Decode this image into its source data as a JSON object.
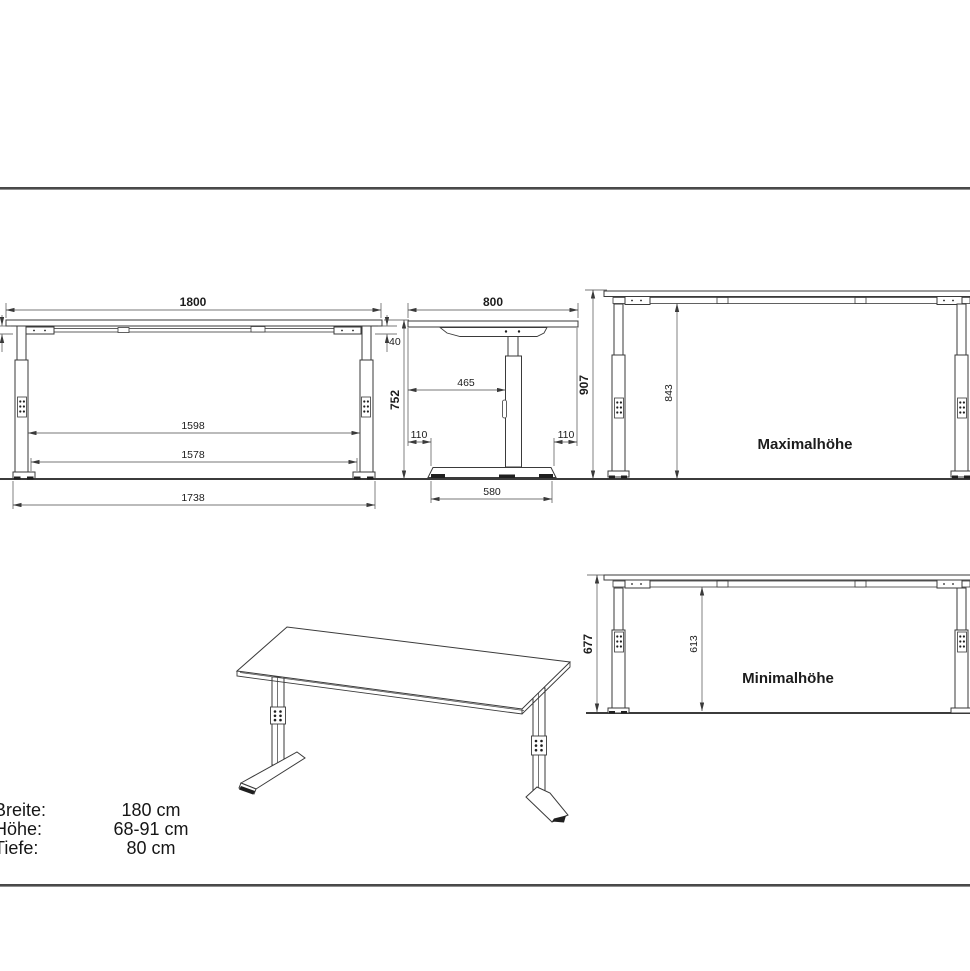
{
  "front_view": {
    "width": "1800",
    "top_frame_offset_right": "40",
    "top_frame_offset_left": "40",
    "height": "752",
    "clear_width_upper": "1598",
    "clear_width_lower": "1578",
    "foot_span": "1738"
  },
  "side_view": {
    "depth": "800",
    "top_to_column": "465",
    "foot_front_offset": "110",
    "foot_rear_offset": "110",
    "foot_length": "580"
  },
  "max_view": {
    "total_height": "907",
    "clearance": "843",
    "label": "Maximalhöhe"
  },
  "min_view": {
    "total_height": "677",
    "clearance": "613",
    "label": "Minimalhöhe"
  },
  "specs": {
    "rows": [
      {
        "label": "Breite:",
        "value": "180 cm"
      },
      {
        "label": "Höhe:",
        "value": "68-91 cm"
      },
      {
        "label": "Tiefe:",
        "value": "80 cm"
      }
    ]
  },
  "colors": {
    "line": "#3a3a3a",
    "divider": "#474747",
    "background": "#ffffff"
  }
}
